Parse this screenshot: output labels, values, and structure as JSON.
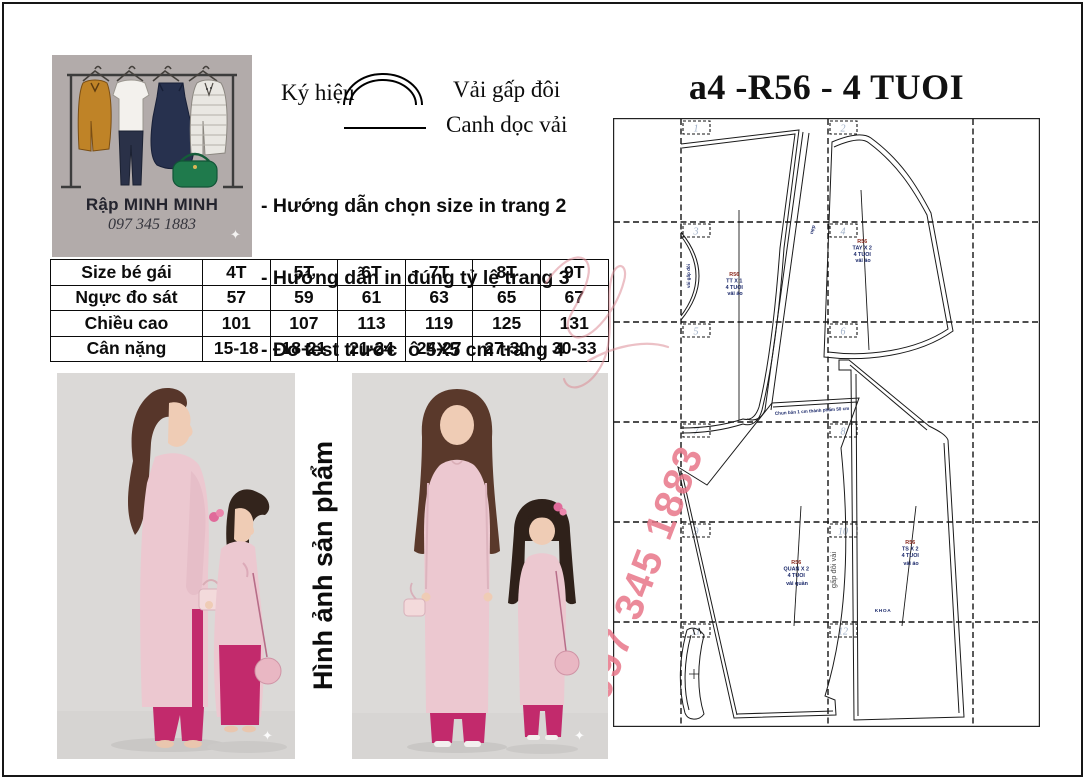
{
  "colors": {
    "logo_bg": "#b2abaa",
    "ao_dai_pink": "#ecc8d0",
    "magenta_pants": "#c22a6c",
    "watermark_pink": "#ee8495",
    "page_number_blue": "#9fb0c8",
    "photo_bg": "#dbd9d7"
  },
  "logo": {
    "brand": "Rập MINH MINH",
    "phone": "097 345 1883",
    "sparkle": "✦"
  },
  "legend": {
    "heading": "Ký hiệu",
    "fold_label": "Vải gấp đôi",
    "grain_label": "Canh dọc vải"
  },
  "notes": {
    "line1": "- Hướng dẫn chọn size in trang 2",
    "line2": "- Hướng dẫn in đúng tỷ lệ trang 3",
    "line3": "- Đo test trước  ô 5X5 cm trang 4"
  },
  "pattern_title": "a4 -R56 - 4 TUOI",
  "size_table": {
    "header": [
      "Size bé gái",
      "4T",
      "5T",
      "6T",
      "7T",
      "8T",
      "9T"
    ],
    "rows": [
      [
        "Ngực đo sát",
        "57",
        "59",
        "61",
        "63",
        "65",
        "67"
      ],
      [
        "Chiều cao",
        "101",
        "107",
        "113",
        "119",
        "125",
        "131"
      ],
      [
        "Cân nặng",
        "15-18",
        "18-21",
        "21-24",
        "24-27",
        "27-30",
        "30-33"
      ]
    ]
  },
  "photos": {
    "caption": "Hình ảnh sản phẩm",
    "sparkle": "✦"
  },
  "pattern": {
    "page_numbers": [
      "1",
      "2",
      "3",
      "4",
      "5",
      "6",
      "7",
      "8",
      "9",
      "10",
      "11",
      "12"
    ],
    "labels": {
      "front": [
        "R56",
        "TT X 1",
        "4 TUOI",
        "vải áo"
      ],
      "sleeve": [
        "R56",
        "TAY X 2",
        "4 TUOI",
        "vải áo"
      ],
      "pants": [
        "R56",
        "QUAN X 2",
        "4 TUOI",
        "vải quần"
      ],
      "back": [
        "R56",
        "TS X 2",
        "4 TUOI",
        "vải áo"
      ]
    },
    "annotations": {
      "body_fold": "vải gấp đôi",
      "pants_fold": "gấp đôi vải",
      "placket": "nẹp",
      "elastic": "Chun bản 1 cm thành phẩm 50 cm",
      "zipper": "KHOA"
    }
  },
  "watermark": {
    "phone": "097 345 1883"
  }
}
